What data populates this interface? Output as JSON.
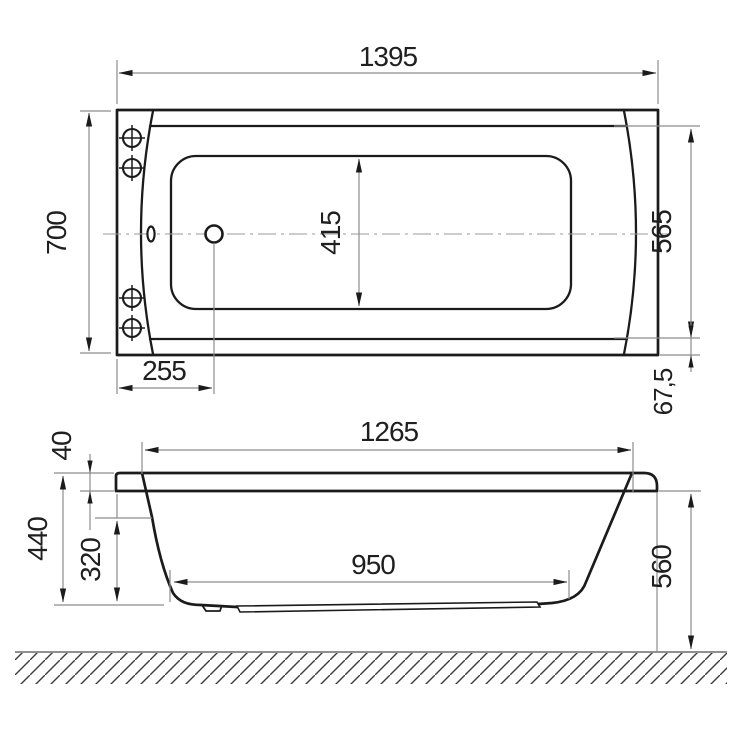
{
  "drawing_title": "Bathtub technical drawing, two orthographic views",
  "style": {
    "background": "#ffffff",
    "ink_color": "#1b1b1b",
    "dimension_line_color": "#8c8c8c",
    "text_color": "#1f1f1f"
  },
  "top_view": {
    "name": "plan view",
    "dims": {
      "overall_length": "1395",
      "overall_width": "700",
      "basin_width": "415",
      "inner_width_right": "565",
      "drain_offset": "255",
      "edge_margin": "67,5"
    }
  },
  "side_view": {
    "name": "side elevation",
    "dims": {
      "top_opening_length": "1265",
      "rim_height": "40",
      "shell_height": "440",
      "inner_depth": "320",
      "bottom_length": "950",
      "mounting_height": "560"
    }
  }
}
